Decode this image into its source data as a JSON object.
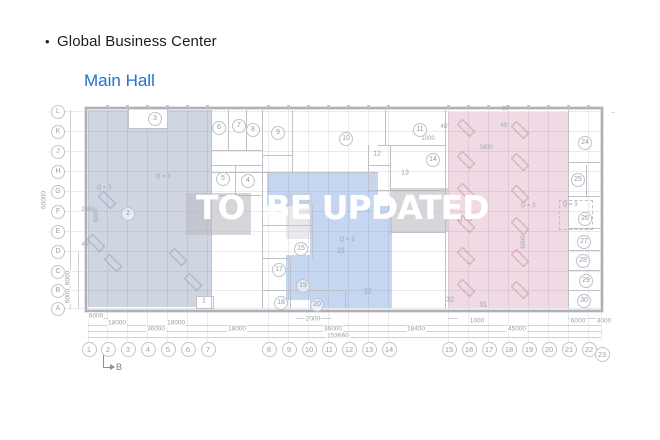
{
  "header": {
    "bullet": "•",
    "title": "Global Business Center",
    "subtitle": "Main Hall"
  },
  "watermark": {
    "text": "TO  BE UPDATED"
  },
  "colors": {
    "accent_blue": "#2470cf",
    "region_left": "rgba(167,181,201,0.55)",
    "region_mid": "rgba(150,180,230,0.55)",
    "region_right": "rgba(222,168,188,0.42)",
    "gray_box": "rgba(186,186,194,0.6)",
    "gray_box_light": "rgba(200,200,208,0.4)",
    "wall": "#bfbfc6",
    "grid": "rgba(120,130,150,0.16)",
    "dim_line": "#d0d0d6",
    "furn_left": "rgba(120,140,170,0.5)",
    "furn_right": "rgba(190,120,145,0.55)"
  },
  "plan": {
    "outline": {
      "x": 85,
      "y": 107,
      "w": 514,
      "h": 201
    },
    "regions": [
      {
        "name": "zone-left",
        "color_key": "region_left",
        "rects": [
          {
            "x": 88,
            "y": 110,
            "w": 123,
            "h": 197
          }
        ]
      },
      {
        "name": "zone-middle",
        "color_key": "region_mid",
        "rects": [
          {
            "x": 267,
            "y": 172,
            "w": 111,
            "h": 34
          },
          {
            "x": 310,
            "y": 206,
            "w": 82,
            "h": 102
          },
          {
            "x": 286,
            "y": 255,
            "w": 24,
            "h": 45
          }
        ]
      },
      {
        "name": "zone-right",
        "color_key": "region_right",
        "rects": [
          {
            "x": 448,
            "y": 112,
            "w": 120,
            "h": 196
          }
        ]
      }
    ],
    "white_boxes": [
      {
        "x": 128,
        "y": 108,
        "w": 38,
        "h": 19
      },
      {
        "x": 196,
        "y": 296,
        "w": 16,
        "h": 11
      }
    ],
    "gray_boxes": [
      {
        "x": 186,
        "y": 193,
        "w": 65,
        "h": 42,
        "light": false
      },
      {
        "x": 286,
        "y": 193,
        "w": 26,
        "h": 46,
        "light": true
      },
      {
        "x": 390,
        "y": 188,
        "w": 58,
        "h": 44,
        "light": false
      }
    ],
    "dashed_boxes": [
      {
        "x": 559,
        "y": 200,
        "w": 32,
        "h": 28
      }
    ],
    "walls": [
      {
        "x": 211,
        "y": 110,
        "w": 1,
        "h": 198
      },
      {
        "x": 228,
        "y": 110,
        "w": 1,
        "h": 41
      },
      {
        "x": 246,
        "y": 110,
        "w": 1,
        "h": 41
      },
      {
        "x": 262,
        "y": 110,
        "w": 1,
        "h": 198
      },
      {
        "x": 212,
        "y": 150,
        "w": 51,
        "h": 1
      },
      {
        "x": 292,
        "y": 110,
        "w": 1,
        "h": 62
      },
      {
        "x": 262,
        "y": 155,
        "w": 30,
        "h": 1
      },
      {
        "x": 385,
        "y": 110,
        "w": 1,
        "h": 36
      },
      {
        "x": 378,
        "y": 145,
        "w": 67,
        "h": 1
      },
      {
        "x": 212,
        "y": 172,
        "w": 166,
        "h": 1
      },
      {
        "x": 368,
        "y": 145,
        "w": 1,
        "h": 46
      },
      {
        "x": 390,
        "y": 145,
        "w": 1,
        "h": 46
      },
      {
        "x": 368,
        "y": 165,
        "w": 23,
        "h": 1
      },
      {
        "x": 368,
        "y": 190,
        "w": 77,
        "h": 1
      },
      {
        "x": 445,
        "y": 110,
        "w": 1,
        "h": 198
      },
      {
        "x": 212,
        "y": 165,
        "w": 51,
        "h": 1
      },
      {
        "x": 212,
        "y": 195,
        "w": 51,
        "h": 1
      },
      {
        "x": 235,
        "y": 165,
        "w": 1,
        "h": 31
      },
      {
        "x": 568,
        "y": 110,
        "w": 1,
        "h": 198
      },
      {
        "x": 568,
        "y": 162,
        "w": 32,
        "h": 1
      },
      {
        "x": 568,
        "y": 196,
        "w": 32,
        "h": 1
      },
      {
        "x": 586,
        "y": 165,
        "w": 1,
        "h": 32
      },
      {
        "x": 568,
        "y": 228,
        "w": 32,
        "h": 1
      },
      {
        "x": 568,
        "y": 250,
        "w": 32,
        "h": 1
      },
      {
        "x": 568,
        "y": 270,
        "w": 32,
        "h": 1
      },
      {
        "x": 568,
        "y": 290,
        "w": 32,
        "h": 1
      },
      {
        "x": 262,
        "y": 225,
        "w": 51,
        "h": 1
      },
      {
        "x": 262,
        "y": 258,
        "w": 29,
        "h": 1
      },
      {
        "x": 290,
        "y": 258,
        "w": 1,
        "h": 50
      },
      {
        "x": 312,
        "y": 206,
        "w": 1,
        "h": 52
      },
      {
        "x": 262,
        "y": 290,
        "w": 84,
        "h": 1
      },
      {
        "x": 345,
        "y": 290,
        "w": 1,
        "h": 18
      },
      {
        "x": 390,
        "y": 232,
        "w": 56,
        "h": 1
      }
    ],
    "furniture": [
      {
        "x": 466,
        "y": 128,
        "zone": "right"
      },
      {
        "x": 520,
        "y": 130,
        "zone": "right"
      },
      {
        "x": 466,
        "y": 160,
        "zone": "right"
      },
      {
        "x": 520,
        "y": 162,
        "zone": "right"
      },
      {
        "x": 466,
        "y": 192,
        "zone": "right"
      },
      {
        "x": 520,
        "y": 194,
        "zone": "right"
      },
      {
        "x": 466,
        "y": 224,
        "zone": "right"
      },
      {
        "x": 520,
        "y": 226,
        "zone": "right"
      },
      {
        "x": 466,
        "y": 256,
        "zone": "right"
      },
      {
        "x": 520,
        "y": 258,
        "zone": "right"
      },
      {
        "x": 466,
        "y": 288,
        "zone": "right"
      },
      {
        "x": 520,
        "y": 290,
        "zone": "right"
      },
      {
        "x": 107,
        "y": 200,
        "zone": "left"
      },
      {
        "x": 96,
        "y": 243,
        "zone": "left"
      },
      {
        "x": 113,
        "y": 263,
        "zone": "left"
      },
      {
        "x": 178,
        "y": 257,
        "zone": "left"
      },
      {
        "x": 193,
        "y": 282,
        "zone": "left"
      }
    ],
    "grid_cols": [
      {
        "label": "1",
        "x": 88
      },
      {
        "label": "2",
        "x": 107
      },
      {
        "label": "3",
        "x": 127
      },
      {
        "label": "4",
        "x": 147
      },
      {
        "label": "5",
        "x": 167
      },
      {
        "label": "6",
        "x": 187
      },
      {
        "label": "7",
        "x": 207
      },
      {
        "label": "8",
        "x": 268
      },
      {
        "label": "9",
        "x": 288
      },
      {
        "label": "10",
        "x": 308
      },
      {
        "label": "11",
        "x": 328
      },
      {
        "label": "12",
        "x": 348
      },
      {
        "label": "13",
        "x": 368
      },
      {
        "label": "14",
        "x": 388
      },
      {
        "label": "15",
        "x": 448
      },
      {
        "label": "16",
        "x": 468
      },
      {
        "label": "17",
        "x": 488
      },
      {
        "label": "18",
        "x": 508
      },
      {
        "label": "19",
        "x": 528
      },
      {
        "label": "20",
        "x": 548
      },
      {
        "label": "21",
        "x": 568
      },
      {
        "label": "22",
        "x": 588
      },
      {
        "label": "23",
        "x": 601,
        "dy": 5
      }
    ],
    "grid_rows": [
      {
        "label": "L",
        "y": 111
      },
      {
        "label": "K",
        "y": 131
      },
      {
        "label": "J",
        "y": 151
      },
      {
        "label": "H",
        "y": 171
      },
      {
        "label": "G",
        "y": 191
      },
      {
        "label": "F",
        "y": 211
      },
      {
        "label": "E",
        "y": 231
      },
      {
        "label": "D",
        "y": 251
      },
      {
        "label": "C",
        "y": 271
      },
      {
        "label": "B",
        "y": 290
      },
      {
        "label": "A",
        "y": 308
      }
    ],
    "room_markers": [
      {
        "label": "2",
        "x": 127,
        "y": 213,
        "circle": true
      },
      {
        "label": "3",
        "x": 154,
        "y": 118,
        "circle": true
      },
      {
        "label": "4",
        "x": 247,
        "y": 180,
        "circle": true
      },
      {
        "label": "5",
        "x": 222,
        "y": 178,
        "circle": true
      },
      {
        "label": "6",
        "x": 218,
        "y": 127,
        "circle": true
      },
      {
        "label": "7",
        "x": 238,
        "y": 125,
        "circle": true
      },
      {
        "label": "8",
        "x": 252,
        "y": 129,
        "circle": true
      },
      {
        "label": "9",
        "x": 277,
        "y": 132,
        "circle": true
      },
      {
        "label": "10",
        "x": 345,
        "y": 138,
        "circle": true
      },
      {
        "label": "11",
        "x": 419,
        "y": 129,
        "circle": true
      },
      {
        "label": "12",
        "x": 377,
        "y": 154,
        "circle": false
      },
      {
        "label": "13",
        "x": 405,
        "y": 173,
        "circle": false
      },
      {
        "label": "14",
        "x": 432,
        "y": 159,
        "circle": true
      },
      {
        "label": "15",
        "x": 300,
        "y": 248,
        "circle": true
      },
      {
        "label": "17",
        "x": 278,
        "y": 269,
        "circle": true
      },
      {
        "label": "18",
        "x": 280,
        "y": 302,
        "circle": true
      },
      {
        "label": "19",
        "x": 302,
        "y": 285,
        "circle": true
      },
      {
        "label": "20",
        "x": 316,
        "y": 304,
        "circle": true
      },
      {
        "label": "21",
        "x": 341,
        "y": 251,
        "circle": false
      },
      {
        "label": "22",
        "x": 368,
        "y": 292,
        "circle": false
      },
      {
        "label": "24",
        "x": 584,
        "y": 142,
        "circle": true
      },
      {
        "label": "25",
        "x": 577,
        "y": 179,
        "circle": true
      },
      {
        "label": "26",
        "x": 584,
        "y": 218,
        "circle": true
      },
      {
        "label": "27",
        "x": 583,
        "y": 241,
        "circle": true
      },
      {
        "label": "28",
        "x": 582,
        "y": 260,
        "circle": true
      },
      {
        "label": "29",
        "x": 585,
        "y": 280,
        "circle": true
      },
      {
        "label": "30",
        "x": 583,
        "y": 300,
        "circle": true
      },
      {
        "label": "31",
        "x": 483,
        "y": 305,
        "circle": false
      },
      {
        "label": "32",
        "x": 450,
        "y": 300,
        "circle": false
      },
      {
        "label": "1",
        "x": 204,
        "y": 301,
        "circle": false
      }
    ],
    "annotations": [
      {
        "t": "Q = 3",
        "x": 163,
        "y": 177
      },
      {
        "t": "Q = 3",
        "x": 104,
        "y": 188
      },
      {
        "t": "2690",
        "x": 88,
        "y": 210
      },
      {
        "t": "5000",
        "x": 97,
        "y": 216,
        "rot": -90
      },
      {
        "t": "45°",
        "x": 86,
        "y": 245
      },
      {
        "t": "Q = 3",
        "x": 347,
        "y": 240
      },
      {
        "t": "Q = 3",
        "x": 465,
        "y": 220
      },
      {
        "t": "Q = 3",
        "x": 528,
        "y": 206
      },
      {
        "t": "Q = 3",
        "x": 570,
        "y": 205
      },
      {
        "t": "45°",
        "x": 445,
        "y": 127
      },
      {
        "t": "45°",
        "x": 505,
        "y": 126
      },
      {
        "t": "1800",
        "x": 486,
        "y": 148
      },
      {
        "t": "1000",
        "x": 428,
        "y": 139
      },
      {
        "t": "23",
        "x": 505,
        "y": 109
      },
      {
        "t": "6000",
        "x": 524,
        "y": 242,
        "rot": -90
      },
      {
        "t": "–",
        "x": 613,
        "y": 113
      }
    ],
    "dim_labels": [
      {
        "t": "6000",
        "x": 96,
        "y": 316
      },
      {
        "t": "18000",
        "x": 117,
        "y": 323
      },
      {
        "t": "18000",
        "x": 176,
        "y": 323
      },
      {
        "t": "2000",
        "x": 313,
        "y": 319
      },
      {
        "t": "36000",
        "x": 156,
        "y": 329
      },
      {
        "t": "18000",
        "x": 237,
        "y": 329
      },
      {
        "t": "36000",
        "x": 333,
        "y": 329
      },
      {
        "t": "153660",
        "x": 338,
        "y": 336
      },
      {
        "t": "18400",
        "x": 416,
        "y": 329
      },
      {
        "t": "1000",
        "x": 477,
        "y": 321
      },
      {
        "t": "45000",
        "x": 517,
        "y": 329
      },
      {
        "t": "6000",
        "x": 578,
        "y": 321
      },
      {
        "t": "3000",
        "x": 604,
        "y": 321
      },
      {
        "t": "60000",
        "x": 44,
        "y": 200,
        "rot": -90
      },
      {
        "t": "6000",
        "x": 68,
        "y": 278,
        "rot": -90
      },
      {
        "t": "6000",
        "x": 68,
        "y": 296,
        "rot": -90
      }
    ],
    "dim_lines": [
      {
        "x": 88,
        "y": 325,
        "w": 513,
        "h": 1
      },
      {
        "x": 88,
        "y": 331,
        "w": 513,
        "h": 1
      },
      {
        "x": 88,
        "y": 337,
        "w": 513,
        "h": 1
      },
      {
        "x": 88,
        "y": 318,
        "w": 20,
        "h": 1
      },
      {
        "x": 296,
        "y": 318,
        "w": 35,
        "h": 1
      },
      {
        "x": 448,
        "y": 318,
        "w": 10,
        "h": 1
      },
      {
        "x": 568,
        "y": 318,
        "w": 33,
        "h": 1
      },
      {
        "x": 70,
        "y": 110,
        "w": 1,
        "h": 199
      },
      {
        "x": 78,
        "y": 252,
        "w": 1,
        "h": 57
      }
    ],
    "section_marker": {
      "label": "B"
    }
  }
}
